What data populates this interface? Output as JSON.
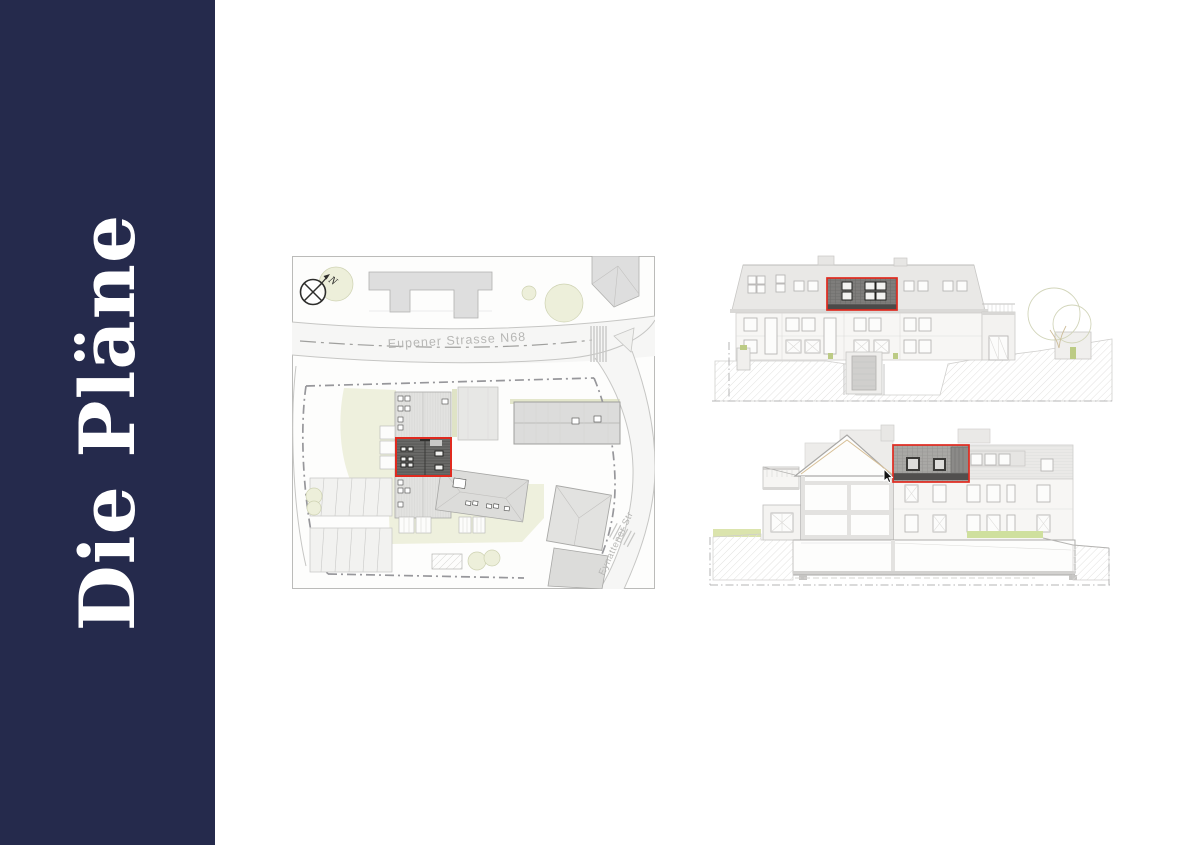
{
  "page": {
    "background": "#ffffff"
  },
  "sidebar": {
    "title": "Die Pläne",
    "background_color": "#252a4c",
    "text_color": "#ffffff"
  },
  "colors": {
    "highlight_red": "#e02a1f",
    "sidebar_navy": "#252a4c",
    "plan_green": "#edefda",
    "building_grey": "#dedede",
    "dark_roof_grey": "#6a6a68"
  },
  "site_plan": {
    "compass_label": "N",
    "street_main": "Eupener Strasse N68",
    "street_side": "Eynattener Str"
  },
  "icons": {
    "compass": "compass-icon",
    "cursor": "cursor-pointer-icon"
  }
}
